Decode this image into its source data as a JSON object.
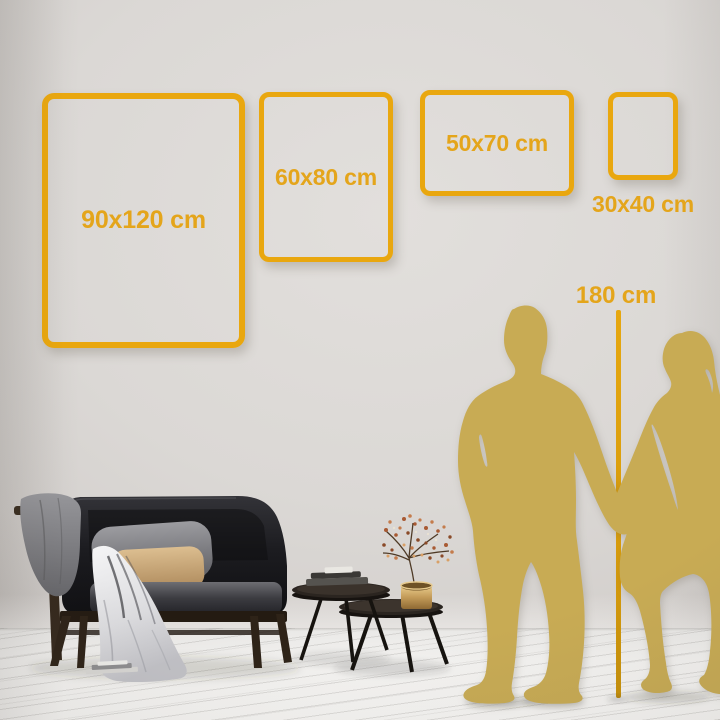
{
  "size_guide": {
    "frames": [
      {
        "label": "90x120 cm",
        "orientation": "portrait"
      },
      {
        "label": "60x80 cm",
        "orientation": "portrait"
      },
      {
        "label": "50x70 cm",
        "orientation": "landscape"
      },
      {
        "label": "30x40 cm",
        "orientation": "portrait"
      }
    ],
    "height_reference_label": "180 cm"
  },
  "colors": {
    "frame_gold": "#E9A70F",
    "label_gold": "#E4A51B",
    "silhouette_gold": "#C8AB54",
    "wall": "#D8D4D1",
    "floor": "#F3F2F0"
  },
  "scene_icons": [
    "sofa",
    "gray-blanket",
    "white-throw",
    "gray-pillow",
    "beige-pillow",
    "nesting-coffee-tables",
    "books",
    "brass-vase",
    "dried-branch",
    "man-silhouette",
    "woman-silhouette",
    "plank-floor",
    "measure-line"
  ]
}
